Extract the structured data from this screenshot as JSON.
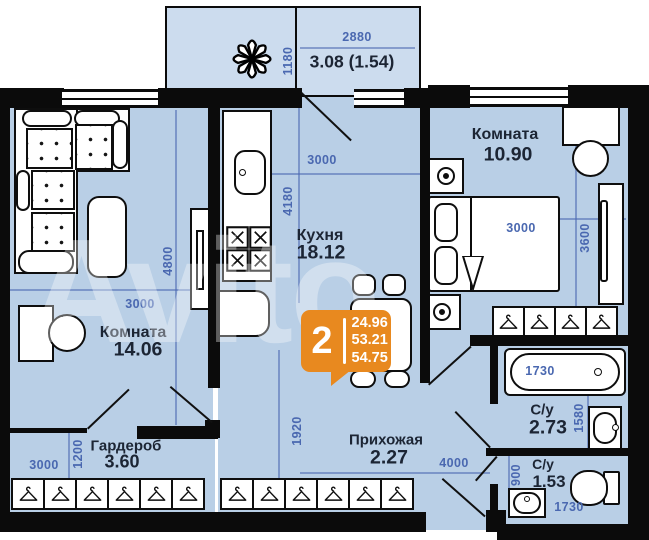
{
  "watermark": "Avito",
  "summary_badge": {
    "rooms_count": "2",
    "values": [
      "24.96",
      "53.21",
      "54.75"
    ]
  },
  "rooms": {
    "balcony": {
      "area_label": "3.08 (1.54)"
    },
    "living": {
      "name": "Комната",
      "area": "14.06"
    },
    "kitchen": {
      "name": "Кухня",
      "area": "18.12"
    },
    "bedroom": {
      "name": "Комната",
      "area": "10.90"
    },
    "wardrobe": {
      "name": "Гардероб",
      "area": "3.60"
    },
    "hallway": {
      "name": "Прихожая",
      "area": "2.27"
    },
    "bathroom": {
      "name": "С/у",
      "area": "2.73"
    },
    "wc": {
      "name": "С/у",
      "area": "1.53"
    }
  },
  "dimensions": {
    "balcony_width": "2880",
    "balcony_depth": "1180",
    "living_width": "3000",
    "living_height": "4800",
    "kitchen_width": "3000",
    "kitchen_height": "4180",
    "bedroom_width": "3000",
    "bedroom_height": "3600",
    "wardrobe_width": "3000",
    "wardrobe_height": "1200",
    "hallway_height": "1920",
    "hallway_width": "4000",
    "bathtub_length": "1730",
    "bathroom_height": "1580",
    "wc_height": "900",
    "wc_width": "1730"
  },
  "colors": {
    "floor": "#b9cfe6",
    "balcony_floor": "#ccdcee",
    "badge": "#e8891f",
    "dimension_text": "#4a68b0",
    "wall": "#0b0b0b"
  }
}
